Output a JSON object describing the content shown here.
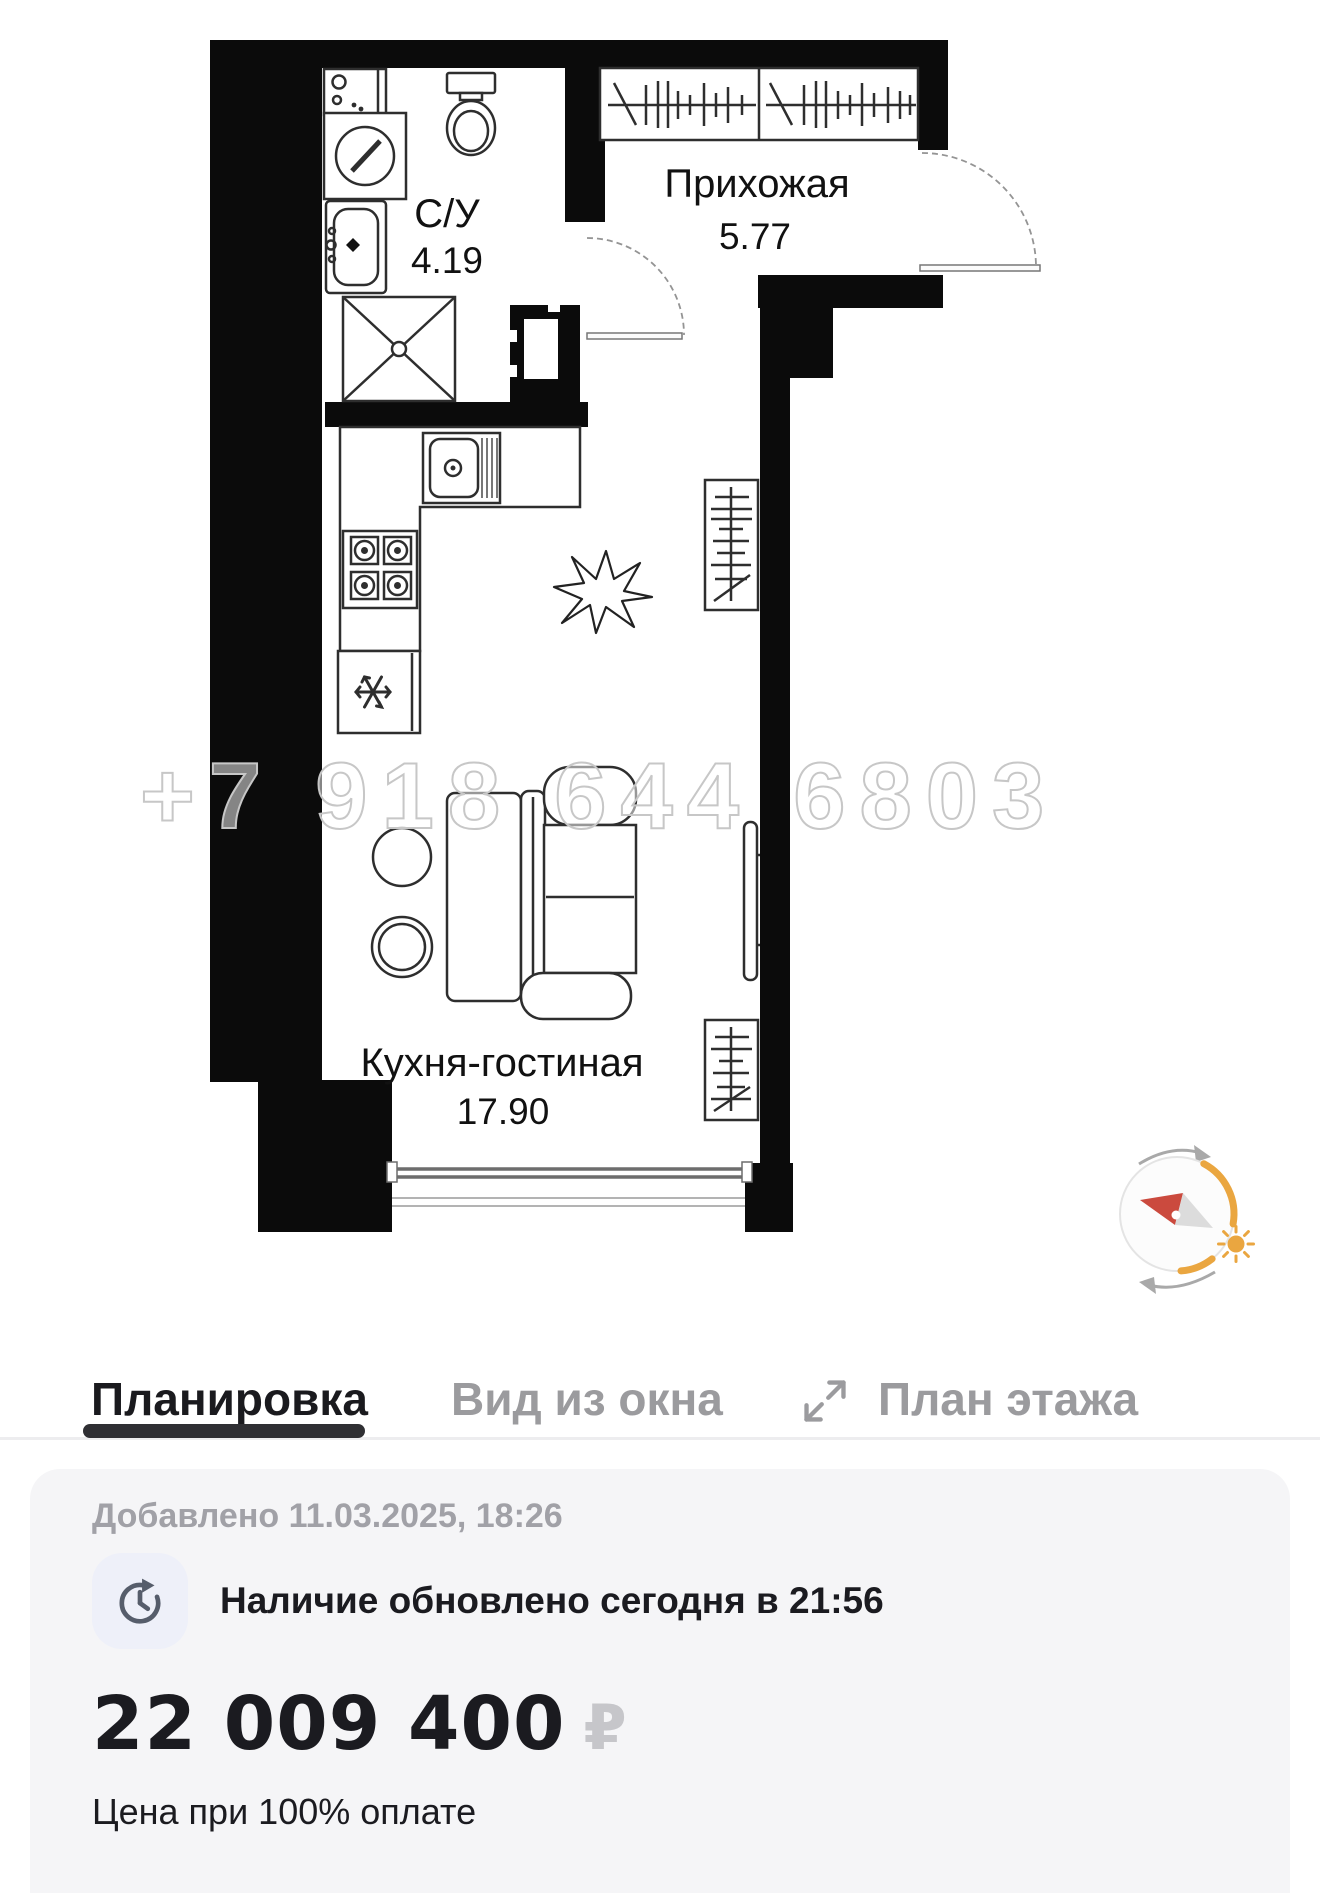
{
  "floor_plan": {
    "rooms": [
      {
        "label": "С/У",
        "area": "4.19"
      },
      {
        "label": "Прихожая",
        "area": "5.77"
      },
      {
        "label": "Кухня-гостиная",
        "area": "17.90"
      }
    ],
    "watermark": "+7 918 644 6803",
    "fixtures": [
      "washing-machine",
      "bathroom-sink",
      "shower",
      "toilet",
      "hall-wardrobe",
      "kitchen-sink",
      "stove",
      "fridge",
      "sofa",
      "coffee-tables",
      "tv",
      "plant",
      "wardrobe",
      "window",
      "entrance-door",
      "bathroom-door"
    ],
    "compass_icon": "compass-sun-rotation"
  },
  "tabs": [
    {
      "label": "Планировка",
      "active": true
    },
    {
      "label": "Вид из окна",
      "active": false
    },
    {
      "label": "План этажа",
      "active": false,
      "icon": "expand-icon"
    }
  ],
  "listing": {
    "added_label": "Добавлено 11.03.2025, 18:26",
    "availability_label": "Наличие обновлено сегодня в 21:56",
    "price": "22 009 400",
    "currency_symbol": "₽",
    "price_note": "Цена при 100% оплате"
  },
  "colors": {
    "walls": "#0b0b0b",
    "accent_orange": "#EAA640",
    "needle_red": "#cb4a3e",
    "card_bg": "#f5f5f7",
    "active_tab": "#1a1a1e",
    "inactive_tab": "#9b9b9e",
    "divider": "#ededef",
    "muted_text": "#a1a1a7",
    "primary_text": "#1b1b20",
    "ruble_gray": "#c6c6ca",
    "watermark_gray": "#c7c7c7"
  }
}
